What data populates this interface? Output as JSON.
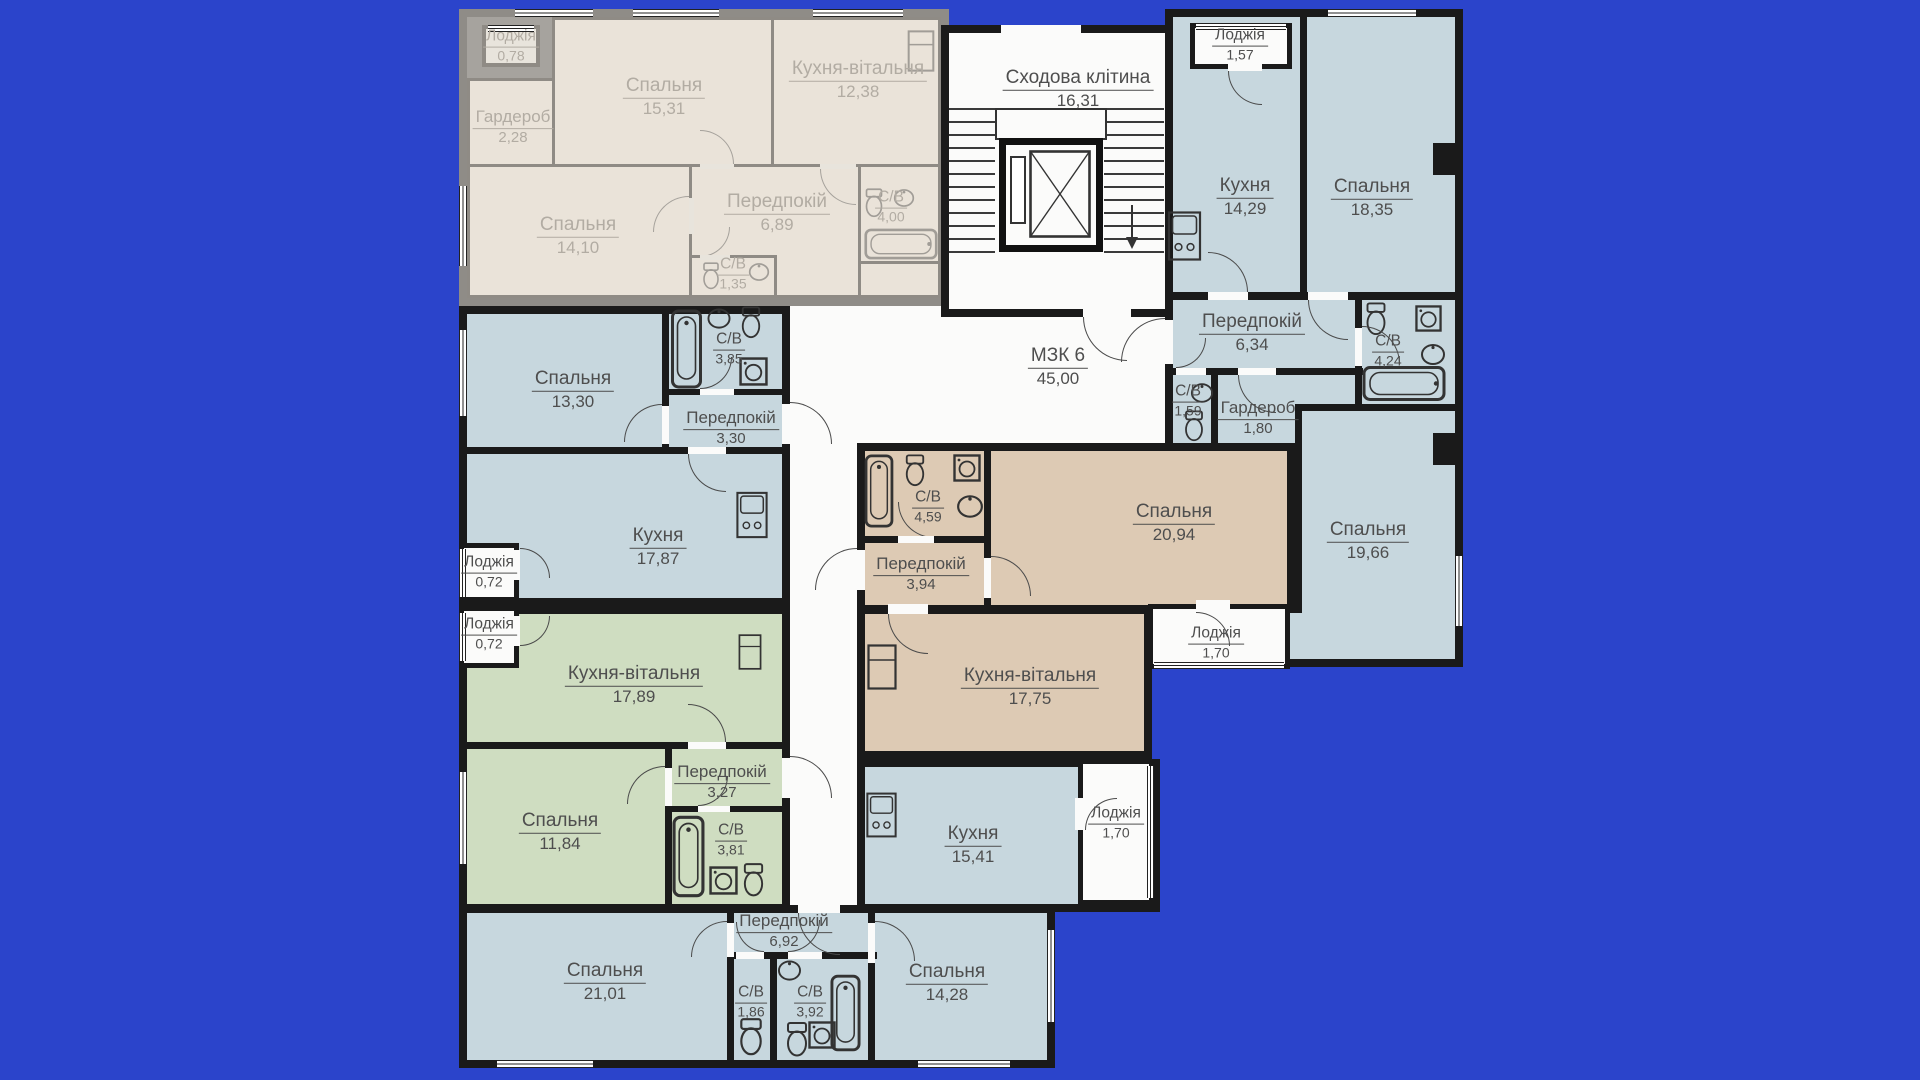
{
  "title": "Поверховий план багатоквартирного будинку",
  "colors": {
    "background": "#2b44cb",
    "wall": "#1a1a1a",
    "unit_blue": "#c7d7de",
    "unit_green": "#cfddc1",
    "unit_beige": "#ddcab4",
    "inactive_room": "#eae3d9",
    "inactive_wall": "#8f8b85",
    "corridor_white": "#fbfbfa",
    "label_text": "#4e4e4e",
    "inactive_label_text": "#b2aca3"
  },
  "icons": [
    "bathtub-icon",
    "toilet-icon",
    "sink-icon",
    "washing-machine-icon",
    "kitchen-unit-icon",
    "fridge-icon",
    "elevator-icon",
    "down-arrow-icon"
  ],
  "apartments": {
    "inactive": {
      "rooms": [
        {
          "name": "Лоджія",
          "area": "0,78"
        },
        {
          "name": "Спальня",
          "area": "15,31"
        },
        {
          "name": "Кухня-вітальня",
          "area": "12,38"
        },
        {
          "name": "Гардероб",
          "area": "2,28"
        },
        {
          "name": "Спальня",
          "area": "14,10"
        },
        {
          "name": "Передпокій",
          "area": "6,89"
        },
        {
          "name": "С/В",
          "area": "1,35"
        },
        {
          "name": "С/В",
          "area": "4,00"
        }
      ]
    },
    "common": {
      "rooms": [
        {
          "name": "Сходова клітина",
          "area": "16,31"
        },
        {
          "name": "МЗК 6",
          "area": "45,00"
        }
      ]
    },
    "right": {
      "rooms": [
        {
          "name": "Лоджія",
          "area": "1,57"
        },
        {
          "name": "Кухня",
          "area": "14,29"
        },
        {
          "name": "Спальня",
          "area": "18,35"
        },
        {
          "name": "Передпокій",
          "area": "6,34"
        },
        {
          "name": "С/В",
          "area": "4,24"
        },
        {
          "name": "С/В",
          "area": "1,59"
        },
        {
          "name": "Гардероб",
          "area": "1,80"
        },
        {
          "name": "Спальня",
          "area": "19,66"
        }
      ]
    },
    "left": {
      "rooms": [
        {
          "name": "Спальня",
          "area": "13,30"
        },
        {
          "name": "С/В",
          "area": "3,85"
        },
        {
          "name": "Передпокій",
          "area": "3,30"
        },
        {
          "name": "Кухня",
          "area": "17,87"
        },
        {
          "name": "Лоджія",
          "area": "0,72"
        }
      ]
    },
    "green": {
      "rooms": [
        {
          "name": "Лоджія",
          "area": "0,72"
        },
        {
          "name": "Кухня-вітальня",
          "area": "17,89"
        },
        {
          "name": "Спальня",
          "area": "11,84"
        },
        {
          "name": "Передпокій",
          "area": "3,27"
        },
        {
          "name": "С/В",
          "area": "3,81"
        }
      ]
    },
    "beige": {
      "rooms": [
        {
          "name": "С/В",
          "area": "4,59"
        },
        {
          "name": "Передпокій",
          "area": "3,94"
        },
        {
          "name": "Спальня",
          "area": "20,94"
        },
        {
          "name": "Кухня-вітальня",
          "area": "17,75"
        },
        {
          "name": "Лоджія",
          "area": "1,70"
        }
      ]
    },
    "bottom": {
      "rooms": [
        {
          "name": "Кухня",
          "area": "15,41"
        },
        {
          "name": "Лоджія",
          "area": "1,70"
        },
        {
          "name": "Спальня",
          "area": "21,01"
        },
        {
          "name": "Передпокій",
          "area": "6,92"
        },
        {
          "name": "С/В",
          "area": "1,86"
        },
        {
          "name": "С/В",
          "area": "3,92"
        },
        {
          "name": "Спальня",
          "area": "14,28"
        }
      ]
    }
  }
}
